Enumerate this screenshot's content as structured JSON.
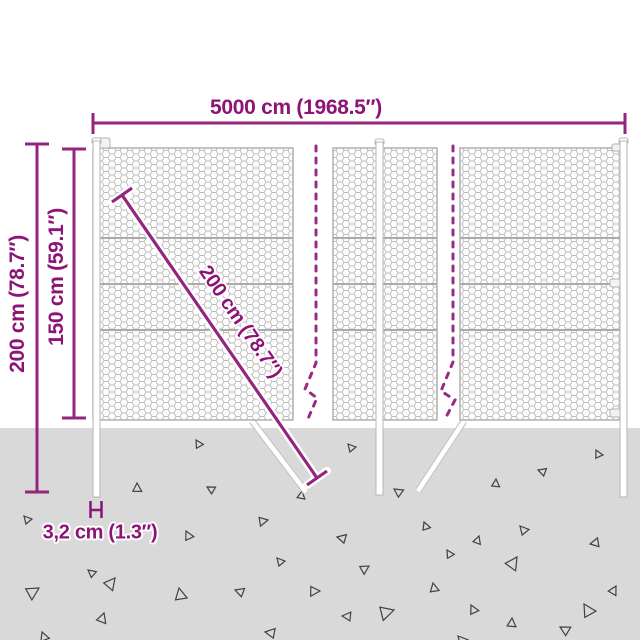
{
  "diagram": {
    "type": "product-dimension-diagram",
    "subject": "chain-link fence with posts",
    "labels": {
      "total_width": "5000 cm (1968.5″)",
      "total_height": "200 cm (78.7″)",
      "fence_height": "150 cm (59.1″)",
      "diagonal_height": "200 cm (78.7″)",
      "post_diameter": "3,2 cm (1.3″)"
    },
    "colors": {
      "accent_text": "#8e1376",
      "dimension_line": "#94257f",
      "break_line": "#9a2a84",
      "ground": "#d9d9d9",
      "mesh_wire": "#bcbcbc",
      "triangle_stroke": "#414141"
    },
    "ground": {
      "triangles": [
        [
          24,
          516,
          8,
          0
        ],
        [
          196,
          440,
          8,
          10
        ],
        [
          137,
          483,
          9,
          40
        ],
        [
          207,
          487,
          8,
          -20
        ],
        [
          186,
          531,
          9,
          15
        ],
        [
          268,
          520,
          9,
          120
        ],
        [
          277,
          558,
          8,
          0
        ],
        [
          115,
          578,
          12,
          80
        ],
        [
          39,
          588,
          13,
          100
        ],
        [
          179,
          588,
          12,
          30
        ],
        [
          235,
          590,
          9,
          -30
        ],
        [
          104,
          613,
          10,
          60
        ],
        [
          42,
          632,
          9,
          20
        ],
        [
          265,
          632,
          10,
          -40
        ],
        [
          302,
          491,
          8,
          50
        ],
        [
          348,
          444,
          8,
          0
        ],
        [
          596,
          450,
          8,
          15
        ],
        [
          538,
          470,
          8,
          -30
        ],
        [
          496,
          479,
          8,
          45
        ],
        [
          394,
          489,
          9,
          -15
        ],
        [
          424,
          522,
          8,
          20
        ],
        [
          337,
          537,
          9,
          -35
        ],
        [
          479,
          536,
          8,
          60
        ],
        [
          447,
          550,
          8,
          10
        ],
        [
          369,
          566,
          9,
          100
        ],
        [
          520,
          526,
          9,
          0
        ],
        [
          517,
          557,
          13,
          75
        ],
        [
          433,
          583,
          9,
          30
        ],
        [
          590,
          544,
          9,
          -60
        ],
        [
          471,
          605,
          9,
          15
        ],
        [
          512,
          618,
          9,
          45
        ],
        [
          560,
          627,
          10,
          -20
        ],
        [
          394,
          610,
          14,
          115
        ],
        [
          342,
          616,
          9,
          -45
        ],
        [
          584,
          604,
          13,
          10
        ],
        [
          616,
          586,
          9,
          70
        ],
        [
          320,
          591,
          10,
          130
        ],
        [
          458,
          636,
          10,
          0
        ],
        [
          88,
          570,
          8,
          -10
        ]
      ]
    }
  }
}
